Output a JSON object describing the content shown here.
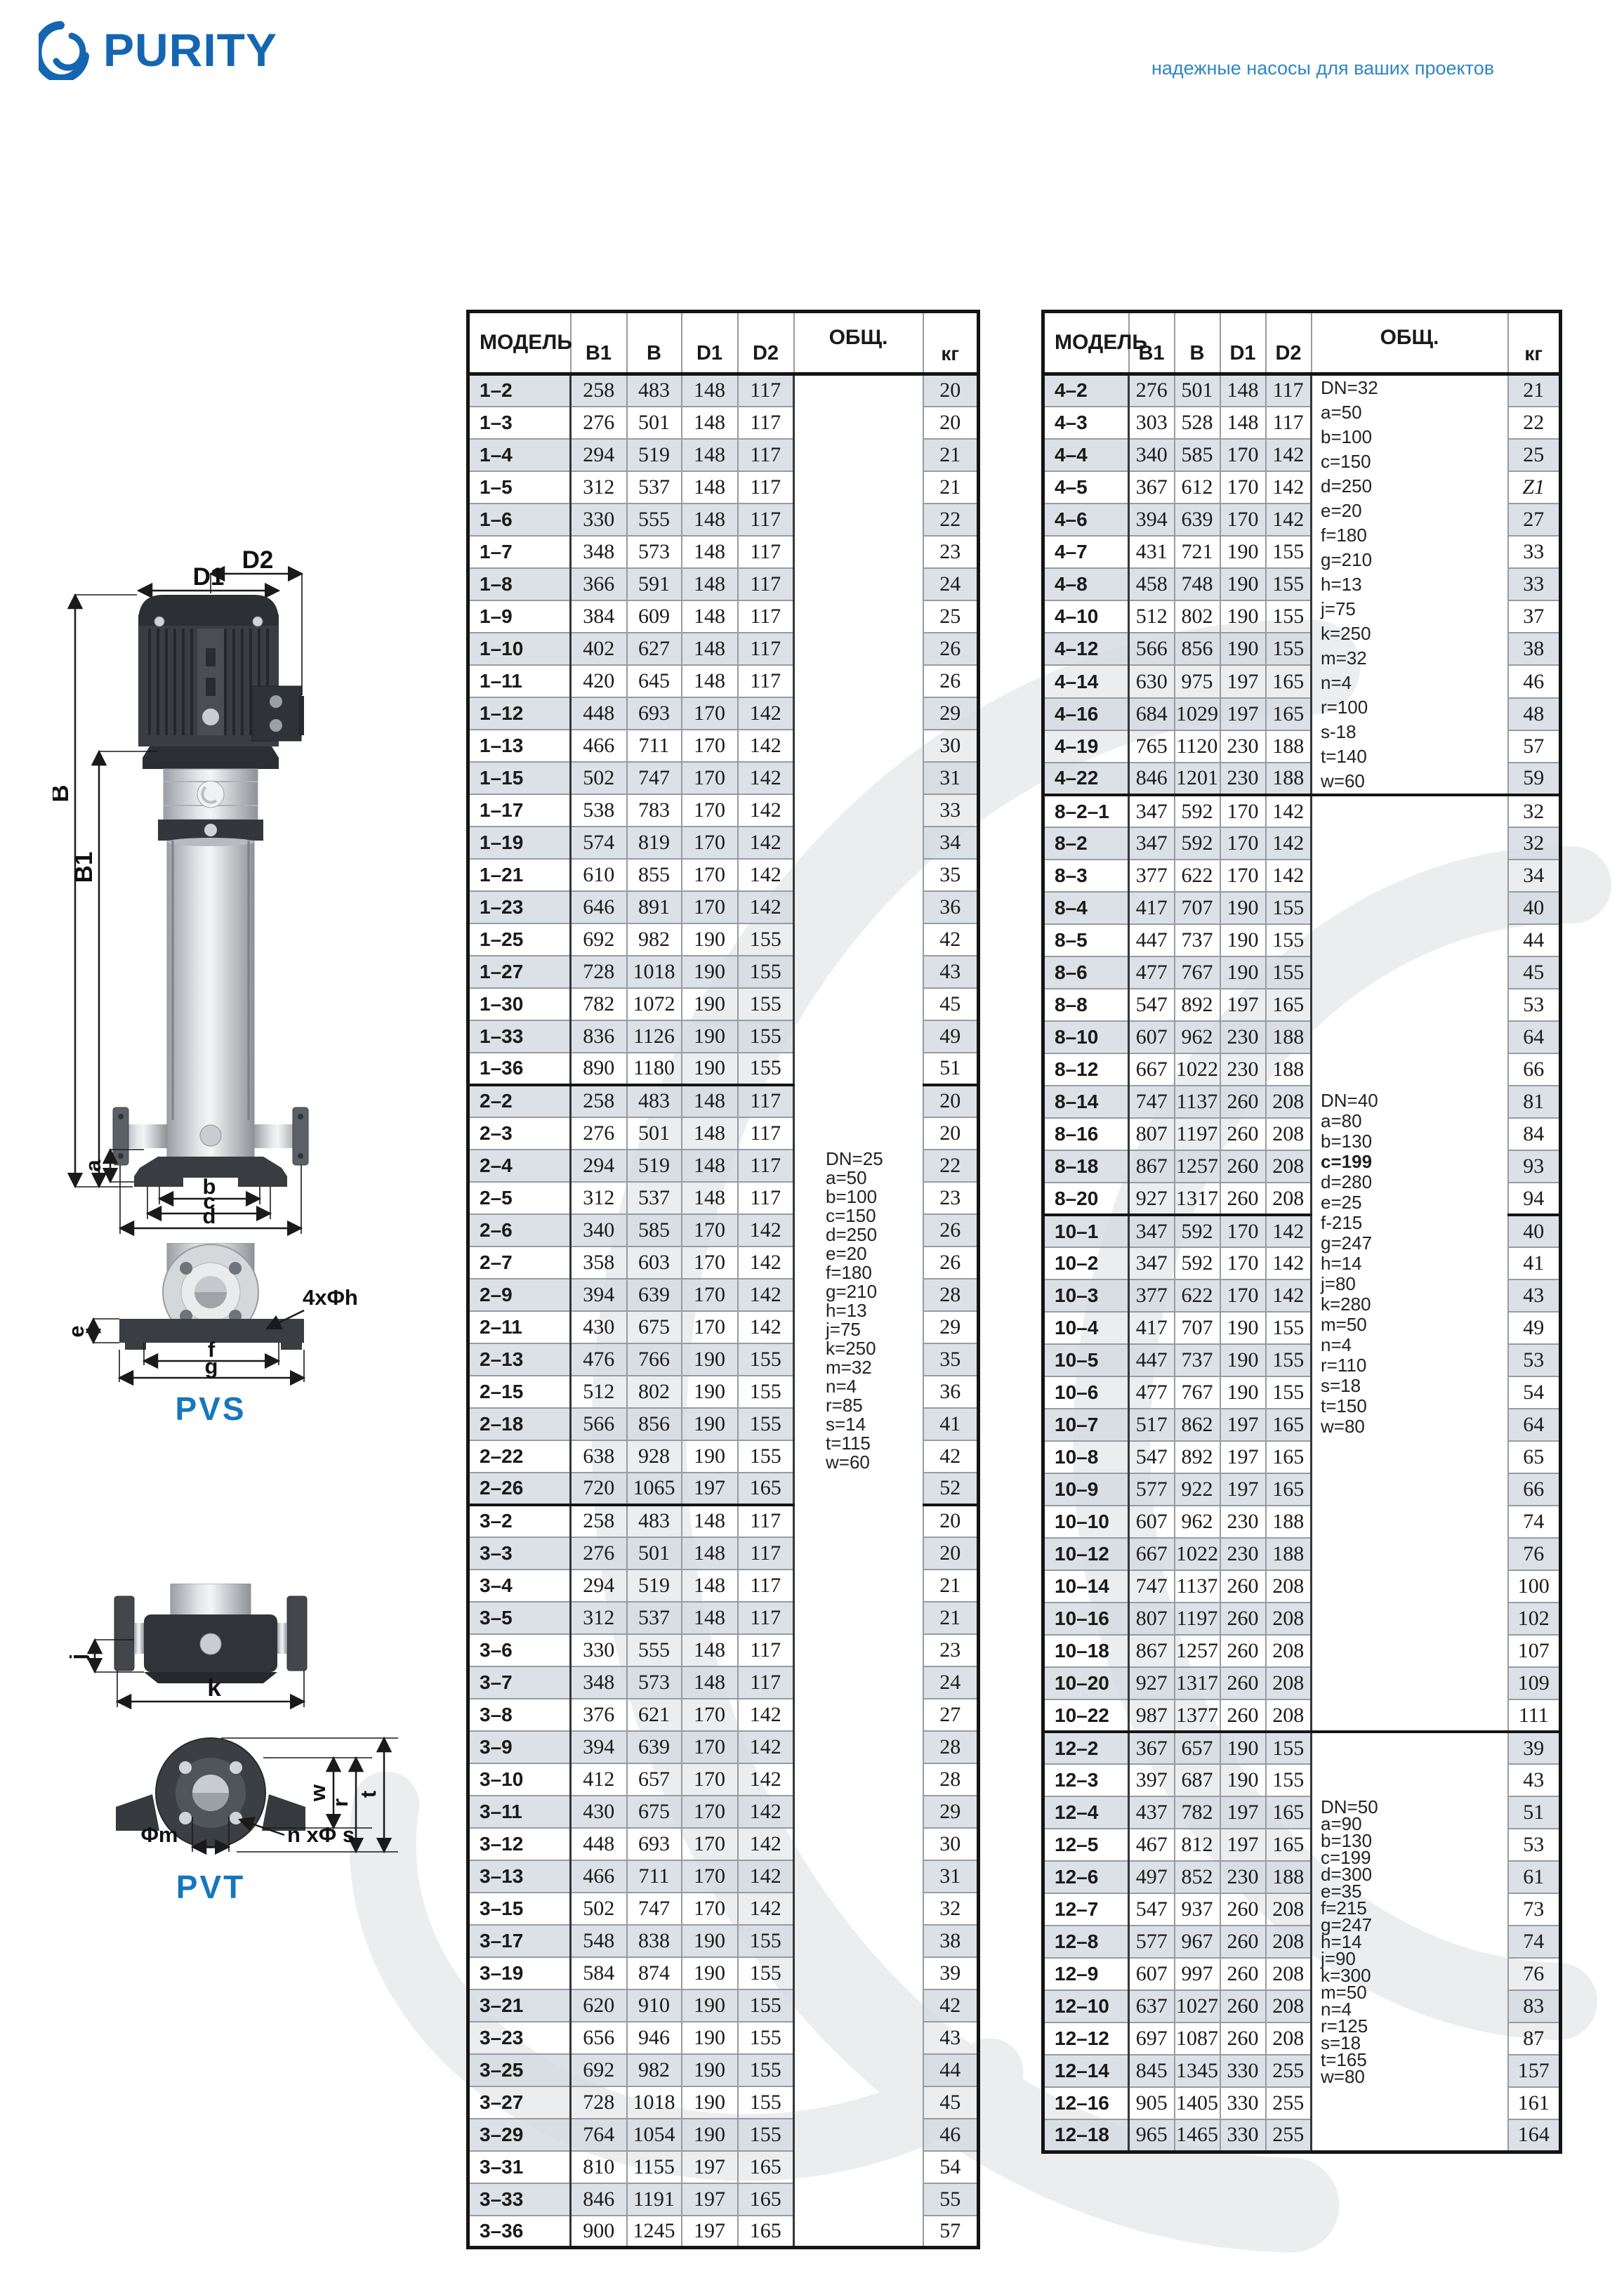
{
  "header": {
    "logo_text": "PURITY",
    "tagline": "надежные насосы для ваших проектов"
  },
  "diagrams": {
    "pvs_label": "PVS",
    "pvt_label": "PVT",
    "dims": {
      "d1": "D1",
      "d2": "D2",
      "b": "B",
      "b1": "B1",
      "la": "a",
      "lb": "b",
      "lc": "c",
      "ld": "d",
      "le": "e",
      "lf": "f",
      "lg": "g",
      "holes4": "4xΦh",
      "lj": "j",
      "lk": "k",
      "lw": "w",
      "lr": "r",
      "lt": "t",
      "phim": "Φm",
      "nphis": "n xΦ s"
    }
  },
  "tables": {
    "left": {
      "columns": [
        "МОДЕЛЬ",
        "B1",
        "B",
        "D1",
        "D2",
        "ОБЩ.",
        "кг"
      ],
      "groups": [
        [
          [
            "1–2",
            258,
            483,
            148,
            117,
            20
          ],
          [
            "1–3",
            276,
            501,
            148,
            117,
            20
          ],
          [
            "1–4",
            294,
            519,
            148,
            117,
            21
          ],
          [
            "1–5",
            312,
            537,
            148,
            117,
            21
          ],
          [
            "1–6",
            330,
            555,
            148,
            117,
            22
          ],
          [
            "1–7",
            348,
            573,
            148,
            117,
            23
          ],
          [
            "1–8",
            366,
            591,
            148,
            117,
            24
          ],
          [
            "1–9",
            384,
            609,
            148,
            117,
            25
          ],
          [
            "1–10",
            402,
            627,
            148,
            117,
            26
          ],
          [
            "1–11",
            420,
            645,
            148,
            117,
            26
          ],
          [
            "1–12",
            448,
            693,
            170,
            142,
            29
          ],
          [
            "1–13",
            466,
            711,
            170,
            142,
            30
          ],
          [
            "1–15",
            502,
            747,
            170,
            142,
            31
          ],
          [
            "1–17",
            538,
            783,
            170,
            142,
            33
          ],
          [
            "1–19",
            574,
            819,
            170,
            142,
            34
          ],
          [
            "1–21",
            610,
            855,
            170,
            142,
            35
          ],
          [
            "1–23",
            646,
            891,
            170,
            142,
            36
          ],
          [
            "1–25",
            692,
            982,
            190,
            155,
            42
          ],
          [
            "1–27",
            728,
            1018,
            190,
            155,
            43
          ],
          [
            "1–30",
            782,
            1072,
            190,
            155,
            45
          ],
          [
            "1–33",
            836,
            1126,
            190,
            155,
            49
          ],
          [
            "1–36",
            890,
            1180,
            190,
            155,
            51
          ]
        ],
        [
          [
            "2–2",
            258,
            483,
            148,
            117,
            20
          ],
          [
            "2–3",
            276,
            501,
            148,
            117,
            20
          ],
          [
            "2–4",
            294,
            519,
            148,
            117,
            22
          ],
          [
            "2–5",
            312,
            537,
            148,
            117,
            23
          ],
          [
            "2–6",
            340,
            585,
            170,
            142,
            26
          ],
          [
            "2–7",
            358,
            603,
            170,
            142,
            26
          ],
          [
            "2–9",
            394,
            639,
            170,
            142,
            28
          ],
          [
            "2–11",
            430,
            675,
            170,
            142,
            29
          ],
          [
            "2–13",
            476,
            766,
            190,
            155,
            35
          ],
          [
            "2–15",
            512,
            802,
            190,
            155,
            36
          ],
          [
            "2–18",
            566,
            856,
            190,
            155,
            41
          ],
          [
            "2–22",
            638,
            928,
            190,
            155,
            42
          ],
          [
            "2–26",
            720,
            1065,
            197,
            165,
            52
          ]
        ],
        [
          [
            "3–2",
            258,
            483,
            148,
            117,
            20
          ],
          [
            "3–3",
            276,
            501,
            148,
            117,
            20
          ],
          [
            "3–4",
            294,
            519,
            148,
            117,
            21
          ],
          [
            "3–5",
            312,
            537,
            148,
            117,
            21
          ],
          [
            "3–6",
            330,
            555,
            148,
            117,
            23
          ],
          [
            "3–7",
            348,
            573,
            148,
            117,
            24
          ],
          [
            "3–8",
            376,
            621,
            170,
            142,
            27
          ],
          [
            "3–9",
            394,
            639,
            170,
            142,
            28
          ],
          [
            "3–10",
            412,
            657,
            170,
            142,
            28
          ],
          [
            "3–11",
            430,
            675,
            170,
            142,
            29
          ],
          [
            "3–12",
            448,
            693,
            170,
            142,
            30
          ],
          [
            "3–13",
            466,
            711,
            170,
            142,
            31
          ],
          [
            "3–15",
            502,
            747,
            170,
            142,
            32
          ],
          [
            "3–17",
            548,
            838,
            190,
            155,
            38
          ],
          [
            "3–19",
            584,
            874,
            190,
            155,
            39
          ],
          [
            "3–21",
            620,
            910,
            190,
            155,
            42
          ],
          [
            "3–23",
            656,
            946,
            190,
            155,
            43
          ],
          [
            "3–25",
            692,
            982,
            190,
            155,
            44
          ],
          [
            "3–27",
            728,
            1018,
            190,
            155,
            45
          ],
          [
            "3–29",
            764,
            1054,
            190,
            155,
            46
          ],
          [
            "3–31",
            810,
            1155,
            197,
            165,
            54
          ],
          [
            "3–33",
            846,
            1191,
            197,
            165,
            55
          ],
          [
            "3–36",
            900,
            1245,
            197,
            165,
            57
          ]
        ]
      ],
      "side_blocks": [
        {
          "groups": [
            0,
            1,
            2
          ],
          "lh": "l",
          "lines": [
            "DN=25",
            "a=50",
            "b=100",
            "c=150",
            "d=250",
            "e=20",
            "f=180",
            "g=210",
            "h=13",
            "j=75",
            "k=250",
            "m=32",
            "n=4",
            "r=85",
            "s=14",
            "t=115",
            "w=60"
          ]
        }
      ]
    },
    "right": {
      "columns": [
        "МОДЕЛЬ",
        "B1",
        "B",
        "D1",
        "D2",
        "ОБЩ.",
        "кг"
      ],
      "groups": [
        [
          [
            "4–2",
            276,
            501,
            148,
            117,
            "21"
          ],
          [
            "4–3",
            303,
            528,
            148,
            117,
            "22"
          ],
          [
            "4–4",
            340,
            585,
            170,
            142,
            "25"
          ],
          [
            "4–5",
            367,
            612,
            170,
            142,
            "Z1"
          ],
          [
            "4–6",
            394,
            639,
            170,
            142,
            "27"
          ],
          [
            "4–7",
            431,
            721,
            190,
            155,
            "33"
          ],
          [
            "4–8",
            458,
            748,
            190,
            155,
            "33"
          ],
          [
            "4–10",
            512,
            802,
            190,
            155,
            "37"
          ],
          [
            "4–12",
            566,
            856,
            190,
            155,
            "38"
          ],
          [
            "4–14",
            630,
            975,
            197,
            165,
            "46"
          ],
          [
            "4–16",
            684,
            1029,
            197,
            165,
            "48"
          ],
          [
            "4–19",
            765,
            1120,
            230,
            188,
            "57"
          ],
          [
            "4–22",
            846,
            1201,
            230,
            188,
            "59"
          ]
        ],
        [
          [
            "8–2–1",
            347,
            592,
            170,
            142,
            32
          ],
          [
            "8–2",
            347,
            592,
            170,
            142,
            32
          ],
          [
            "8–3",
            377,
            622,
            170,
            142,
            34
          ],
          [
            "8–4",
            417,
            707,
            190,
            155,
            40
          ],
          [
            "8–5",
            447,
            737,
            190,
            155,
            44
          ],
          [
            "8–6",
            477,
            767,
            190,
            155,
            45
          ],
          [
            "8–8",
            547,
            892,
            197,
            165,
            53
          ],
          [
            "8–10",
            607,
            962,
            230,
            188,
            64
          ],
          [
            "8–12",
            667,
            1022,
            230,
            188,
            66
          ],
          [
            "8–14",
            747,
            1137,
            260,
            208,
            81
          ],
          [
            "8–16",
            807,
            1197,
            260,
            208,
            84
          ],
          [
            "8–18",
            867,
            1257,
            260,
            208,
            93
          ],
          [
            "8–20",
            927,
            1317,
            260,
            208,
            94
          ]
        ],
        [
          [
            "10–1",
            347,
            592,
            170,
            142,
            40
          ],
          [
            "10–2",
            347,
            592,
            170,
            142,
            41
          ],
          [
            "10–3",
            377,
            622,
            170,
            142,
            43
          ],
          [
            "10–4",
            417,
            707,
            190,
            155,
            49
          ],
          [
            "10–5",
            447,
            737,
            190,
            155,
            53
          ],
          [
            "10–6",
            477,
            767,
            190,
            155,
            54
          ],
          [
            "10–7",
            517,
            862,
            197,
            165,
            64
          ],
          [
            "10–8",
            547,
            892,
            197,
            165,
            65
          ],
          [
            "10–9",
            577,
            922,
            197,
            165,
            66
          ],
          [
            "10–10",
            607,
            962,
            230,
            188,
            74
          ],
          [
            "10–12",
            667,
            1022,
            230,
            188,
            76
          ],
          [
            "10–14",
            747,
            1137,
            260,
            208,
            100
          ],
          [
            "10–16",
            807,
            1197,
            260,
            208,
            102
          ],
          [
            "10–18",
            867,
            1257,
            260,
            208,
            107
          ],
          [
            "10–20",
            927,
            1317,
            260,
            208,
            109
          ],
          [
            "10–22",
            987,
            1377,
            260,
            208,
            111
          ]
        ],
        [
          [
            "12–2",
            367,
            657,
            190,
            155,
            39
          ],
          [
            "12–3",
            397,
            687,
            190,
            155,
            43
          ],
          [
            "12–4",
            437,
            782,
            197,
            165,
            51
          ],
          [
            "12–5",
            467,
            812,
            197,
            165,
            53
          ],
          [
            "12–6",
            497,
            852,
            230,
            188,
            61
          ],
          [
            "12–7",
            547,
            937,
            260,
            208,
            73
          ],
          [
            "12–8",
            577,
            967,
            260,
            208,
            74
          ],
          [
            "12–9",
            607,
            997,
            260,
            208,
            76
          ],
          [
            "12–10",
            637,
            1027,
            260,
            208,
            83
          ],
          [
            "12–12",
            697,
            1087,
            260,
            208,
            87
          ],
          [
            "12–14",
            845,
            1345,
            330,
            255,
            157
          ],
          [
            "12–16",
            905,
            1405,
            330,
            255,
            161
          ],
          [
            "12–18",
            965,
            1465,
            330,
            255,
            164
          ]
        ]
      ],
      "side_blocks": [
        {
          "groups": [
            0
          ],
          "lh": "a",
          "lines": [
            "DN=32",
            "a=50",
            "b=100",
            "c=150",
            "d=250",
            "e=20",
            "f=180",
            "g=210",
            "h=13",
            "j=75",
            "k=250",
            "m=32",
            "n=4",
            "r=100",
            "s-18",
            "t=140",
            "w=60"
          ]
        },
        {
          "groups": [
            1,
            2
          ],
          "lh": "b",
          "bold": [
            3
          ],
          "lines": [
            "DN=40",
            "a=80",
            "b=130",
            "c=199",
            "d=280",
            "e=25",
            "f-215",
            "g=247",
            "h=14",
            "j=80",
            "k=280",
            "m=50",
            "n=4",
            "r=110",
            "s=18",
            "t=150",
            "w=80"
          ]
        },
        {
          "groups": [
            3
          ],
          "lh": "c",
          "lines": [
            "DN=50",
            "a=90",
            "b=130",
            "c=199",
            "d=300",
            "e=35",
            "f=215",
            "g=247",
            "h=14",
            "j=90",
            "k=300",
            "m=50",
            "n=4",
            "r=125",
            "s=18",
            "t=165",
            "w=80"
          ]
        }
      ]
    }
  }
}
